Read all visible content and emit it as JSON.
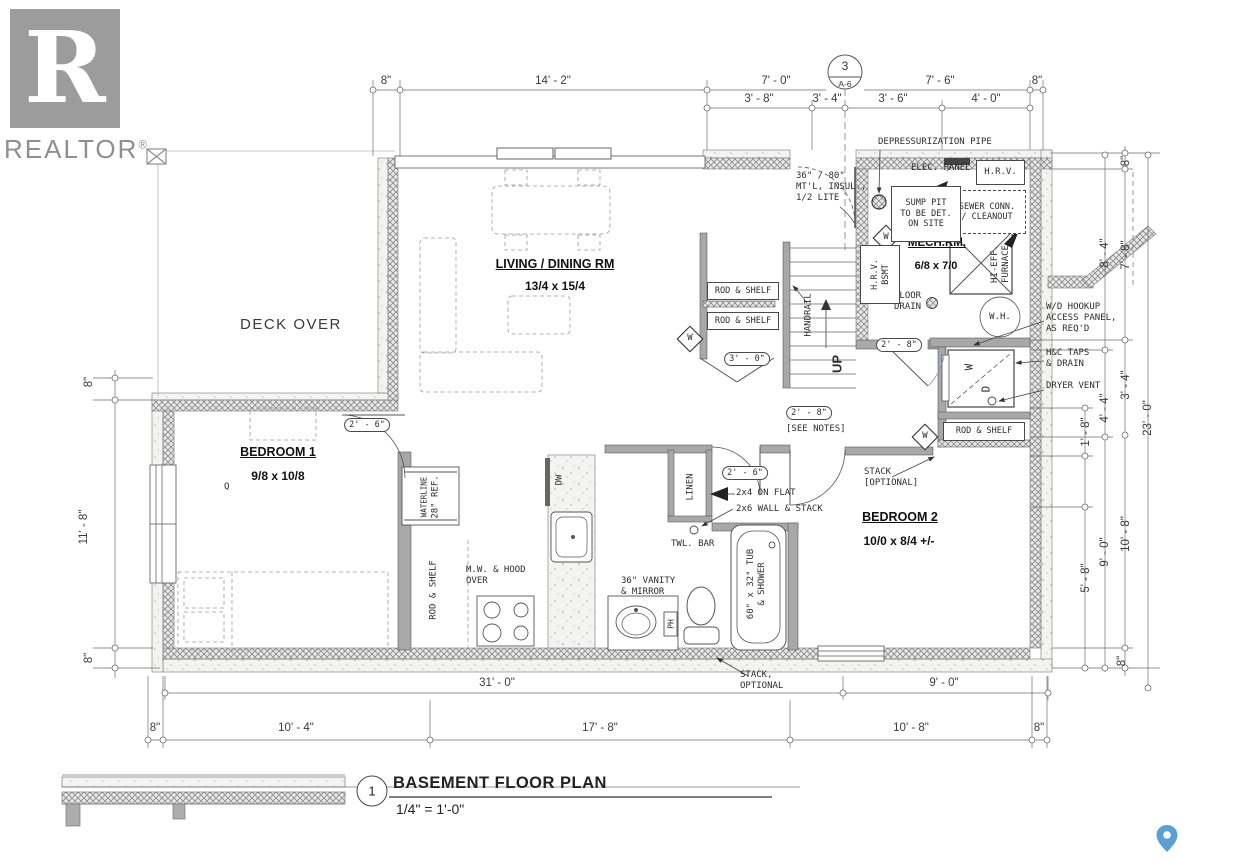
{
  "logo": {
    "letter": "R",
    "brand": "REALTOR",
    "registered": "®"
  },
  "title_block": {
    "detail_number": "1",
    "title": "BASEMENT FLOOR PLAN",
    "scale": "1/4\" = 1'-0\""
  },
  "section_bubble": {
    "number": "3",
    "sheet": "A-6"
  },
  "rooms": {
    "living": {
      "name": "LIVING / DINING RM",
      "size": "13/4 x 15/4"
    },
    "bedroom1": {
      "name": "BEDROOM 1",
      "size": "9/8 x 10/8"
    },
    "bedroom2": {
      "name": "BEDROOM 2",
      "size": "10/0 x 8/4 +/-"
    },
    "mech": {
      "name": "MECH.RM.",
      "size": "6/8 x 7/0"
    },
    "deck": {
      "name": "DECK OVER"
    }
  },
  "labels": {
    "depressurization_pipe": "DEPRESSURIZATION PIPE",
    "elec_panel": "ELEC. PANEL",
    "hrv": "H.R.V.",
    "sewer_line1": "SEWER CONN.",
    "sewer_line2": "/ CLEANOUT",
    "sump_line1": "SUMP PIT",
    "sump_line2": "TO BE DET.",
    "sump_line3": "ON SITE",
    "door36_line1": "36\" / 80\"",
    "door36_line2": "MT'L, INSUL.,",
    "door36_line3": "1/2 LITE",
    "hrv_bsmt_line1": "H.R.V.",
    "hrv_bsmt_line2": "BSMT",
    "hi_eff_line1": "HI-EFF.",
    "hi_eff_line2": "FURNACE",
    "floor_drain_line1": "FLOOR",
    "floor_drain_line2": "DRAIN",
    "water_heater": "W.H.",
    "wd_hookup_line1": "W/D HOOKUP",
    "wd_hookup_line2": "ACCESS PANEL,",
    "wd_hookup_line3": "AS REQ'D",
    "hc_taps_line1": "H&C TAPS",
    "hc_taps_line2": "& DRAIN",
    "dryer_vent": "DRYER VENT",
    "rod_shelf": "ROD & SHELF",
    "handrail": "HANDRAIL",
    "up": "UP",
    "window_symbol": "W",
    "washer": "W",
    "dryer": "D",
    "linen": "LINEN",
    "towel_bar": "TWL. BAR",
    "vanity_line1": "36\" VANITY",
    "vanity_line2": "& MIRROR",
    "ph": "PH",
    "tub_line1": "60\" x 32\" TUB",
    "tub_line2": "& SHOWER",
    "microwave_line1": "M.W. & HOOD",
    "microwave_line2": "OVER",
    "waterline": "WATERLINE",
    "fridge": "28\" REF.",
    "dishwasher": "DW",
    "on_flat": "2x4 ON FLAT",
    "wall_stack": "2x6 WALL & STACK",
    "stack_line1": "STACK",
    "stack_line2": "[OPTIONAL]",
    "stack_b_line1": "STACK,",
    "stack_b_line2": "OPTIONAL",
    "see_notes": "[SEE NOTES]",
    "queen": "Q"
  },
  "door_tags": {
    "bedroom1": "2' - 6\"",
    "bathroom": "2' - 6\"",
    "bedroom2": "2' - 8\"",
    "mech": "2' - 8\"",
    "closet": "3' - 0\""
  },
  "dimensions": {
    "top_row1": [
      "8\"",
      "14' - 2\"",
      "7' - 0\"",
      "7' - 6\"",
      "8\""
    ],
    "top_row2": [
      "3' - 8\"",
      "3' - 4\"",
      "3' - 6\"",
      "4' - 0\""
    ],
    "right": [
      "8\"",
      "8' - 4\"",
      "7' - 8\"",
      "3' - 4\"",
      "4' - 4\"",
      "1' - 8\"",
      "23' - 0\"",
      "5' - 8\"",
      "9' - 0\"",
      "10' - 8\"",
      "8\""
    ],
    "left": [
      "8\"",
      "11' - 8\"",
      "8\""
    ],
    "bottom_row1": [
      "31' - 0\"",
      "9' - 0\""
    ],
    "bottom_row2": [
      "8\"",
      "10' - 4\"",
      "17' - 8\"",
      "10' - 8\"",
      "8\""
    ]
  },
  "colors": {
    "line": "#4a4a4a",
    "wall_gray": "#a8a8a8",
    "logo_gray": "#9c9c9c",
    "pin_blue": "#5b9fd4"
  }
}
